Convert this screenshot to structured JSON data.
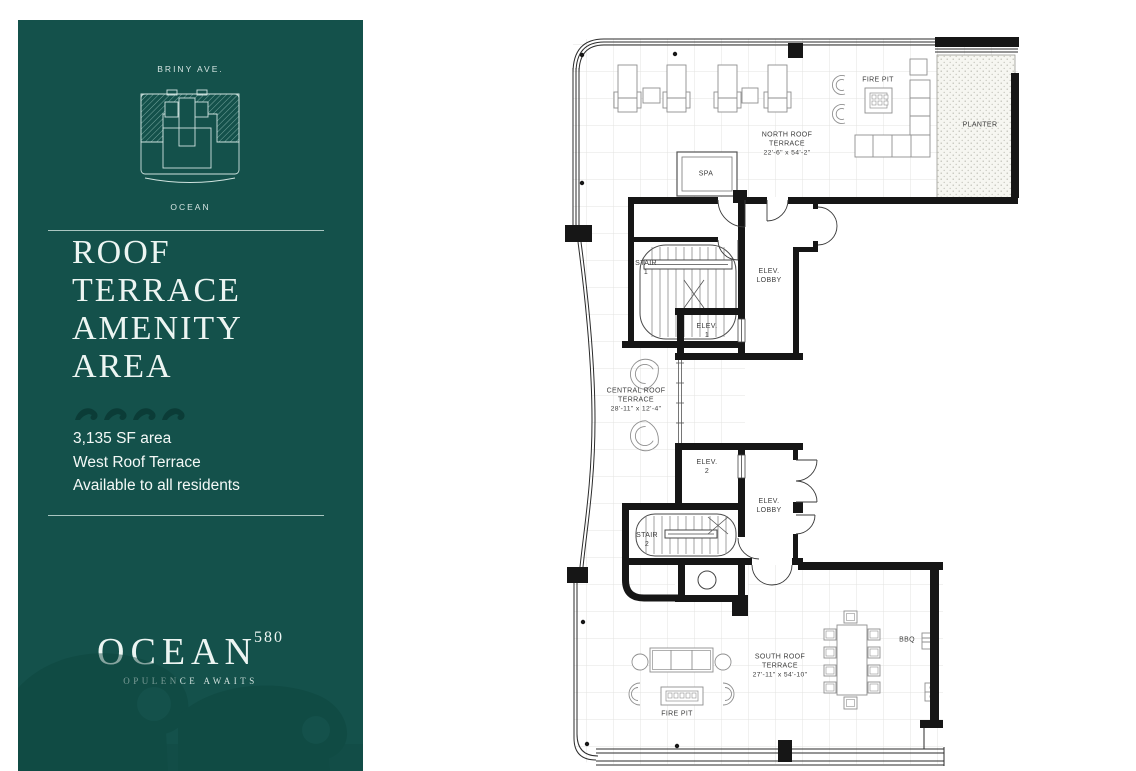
{
  "colors": {
    "sidebar_bg": "#14514B",
    "sidebar_text": "#ECF5F2",
    "wave_icon": "#0B3C37",
    "wall": "#161616",
    "plan_label": "#3C3C3C",
    "grid_line": "#E3E3E0"
  },
  "sidebar": {
    "street_label": "BRINY AVE.",
    "ocean_label": "OCEAN",
    "title_lines": [
      "ROOF",
      "TERRACE",
      "AMENITY",
      "AREA"
    ],
    "details": [
      "3,135 SF area",
      "West Roof Terrace",
      "Available to all residents"
    ],
    "logo": {
      "name": "OCEAN",
      "number": "580",
      "tagline": "OPULENCE AWAITS"
    }
  },
  "plan": {
    "north_terrace": {
      "name": "NORTH ROOF TERRACE",
      "dims": "22'-6\" x 54'-2\""
    },
    "central_terrace": {
      "name": "CENTRAL ROOF TERRACE",
      "dims": "28'-11\" x 12'-4\""
    },
    "south_terrace": {
      "name": "SOUTH ROOF TERRACE",
      "dims": "27'-11\" x 54'-10\""
    },
    "rooms": {
      "spa": "SPA",
      "stair1": "STAIR 1",
      "stair2": "STAIR 2",
      "elev1": "ELEV. 1",
      "elev2": "ELEV. 2",
      "elev_lobby": "ELEV. LOBBY",
      "planter": "PLANTER",
      "fire_pit": "FIRE PIT",
      "bbq": "BBQ"
    }
  }
}
